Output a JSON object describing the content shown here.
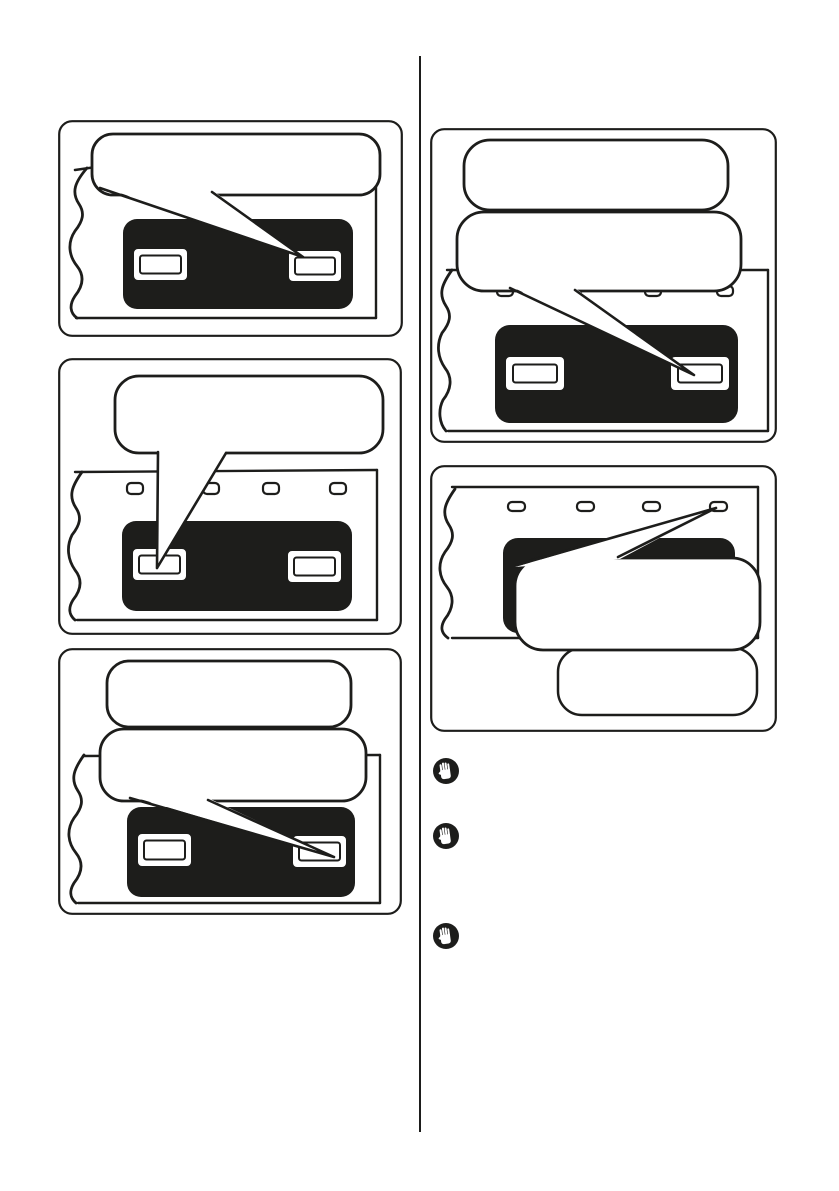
{
  "page": {
    "kind": "instruction-manual-page",
    "background": "#ffffff",
    "ink": "#1d1d1b",
    "bubble_fill": "#ffffff",
    "panel_fill": "#1d1d1b"
  },
  "figures": {
    "left1": {
      "name": "figure-left-top",
      "content": "panel-with-two-slots",
      "bubbles": [
        {
          "text": "",
          "tail": "points-to-right-slot"
        }
      ]
    },
    "left2": {
      "name": "figure-left-middle",
      "content": "panel-with-two-slots-and-four-vents",
      "bubbles": [
        {
          "text": "",
          "tail": "points-to-left-slot"
        }
      ]
    },
    "left3": {
      "name": "figure-left-bottom",
      "content": "panel-with-two-slots",
      "bubbles": [
        {
          "text": "",
          "tail": "none"
        },
        {
          "text": "",
          "tail": "points-to-right-slot"
        }
      ]
    },
    "right1": {
      "name": "figure-right-top",
      "content": "panel-with-two-slots-and-four-vents",
      "bubbles": [
        {
          "text": "",
          "tail": "none"
        },
        {
          "text": "",
          "tail": "points-to-right-slot"
        }
      ]
    },
    "right2": {
      "name": "figure-right-bottom",
      "content": "panel-with-two-slots-and-four-vents",
      "bubbles": [
        {
          "text": "",
          "tail": "points-to-top-right-vent"
        },
        {
          "text": "",
          "tail": "none"
        }
      ]
    }
  },
  "notes": [
    {
      "icon": "hand-stop-icon",
      "text": ""
    },
    {
      "icon": "hand-stop-icon",
      "text": ""
    },
    {
      "icon": "hand-stop-icon",
      "text": ""
    }
  ]
}
